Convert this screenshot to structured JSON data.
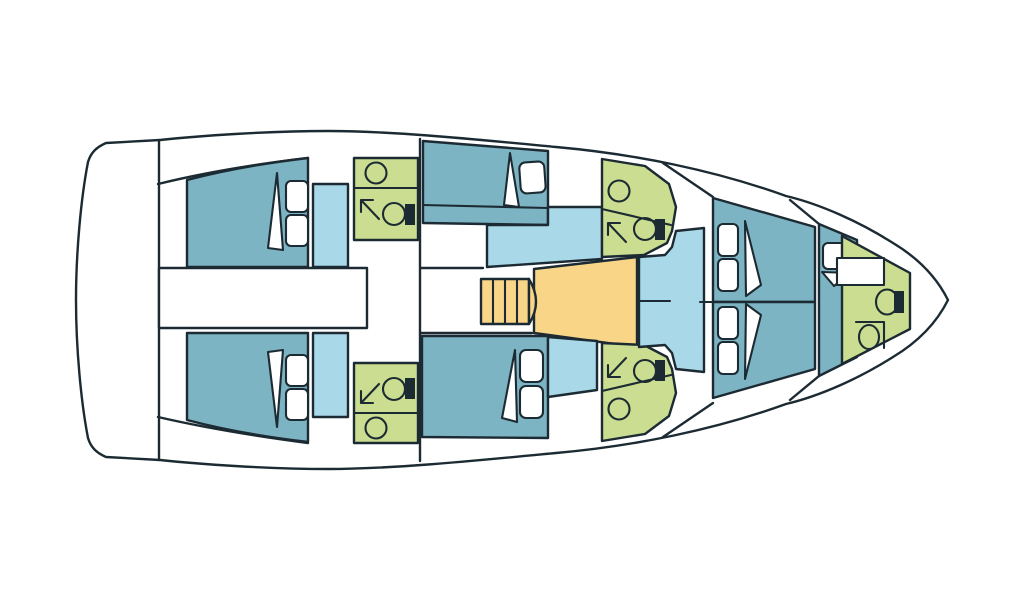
{
  "diagram": {
    "type": "yacht-floor-plan",
    "view": "top-down deck plan, bow pointing right, no visible text",
    "colors": {
      "background": "#ffffff",
      "hull": "#ffffff",
      "outline": "#1c2b33",
      "cabin": "#7db4c3",
      "walkway": "#a9d8e9",
      "bathroom": "#cbdd90",
      "galley": "#f9d588",
      "fixture": "#ffffff",
      "tank": "#1c2b33"
    },
    "rooms": [
      {
        "id": "aft-cabin-port",
        "kind": "double-cabin",
        "fill": "cabin"
      },
      {
        "id": "aft-cabin-starboard",
        "kind": "double-cabin",
        "fill": "cabin"
      },
      {
        "id": "aft-head-port",
        "kind": "bathroom",
        "fill": "bathroom"
      },
      {
        "id": "aft-head-starboard",
        "kind": "bathroom",
        "fill": "bathroom"
      },
      {
        "id": "midship-berth-port",
        "kind": "berth",
        "fill": "cabin"
      },
      {
        "id": "midship-berth-starboard",
        "kind": "berth",
        "fill": "cabin"
      },
      {
        "id": "mid-head-port",
        "kind": "bathroom",
        "fill": "bathroom"
      },
      {
        "id": "mid-head-starboard",
        "kind": "bathroom",
        "fill": "bathroom"
      },
      {
        "id": "galley-area",
        "kind": "galley",
        "fill": "galley"
      },
      {
        "id": "companionway-stairs",
        "kind": "stairs",
        "fill": "galley"
      },
      {
        "id": "salon-seating",
        "kind": "seating",
        "fill": "walkway"
      },
      {
        "id": "forward-cabin-port",
        "kind": "v-berth",
        "fill": "cabin"
      },
      {
        "id": "forward-cabin-starboard",
        "kind": "v-berth",
        "fill": "cabin"
      },
      {
        "id": "forward-berth",
        "kind": "single-berth",
        "fill": "cabin"
      },
      {
        "id": "bow-head",
        "kind": "bathroom",
        "fill": "bathroom"
      },
      {
        "id": "engine-compartment",
        "kind": "storage",
        "fill": "hull"
      }
    ],
    "icons": [
      "pillow-icon",
      "blanket-icon",
      "sink-icon",
      "toilet-icon",
      "shower-arrow-icon",
      "stairs-icon"
    ]
  }
}
